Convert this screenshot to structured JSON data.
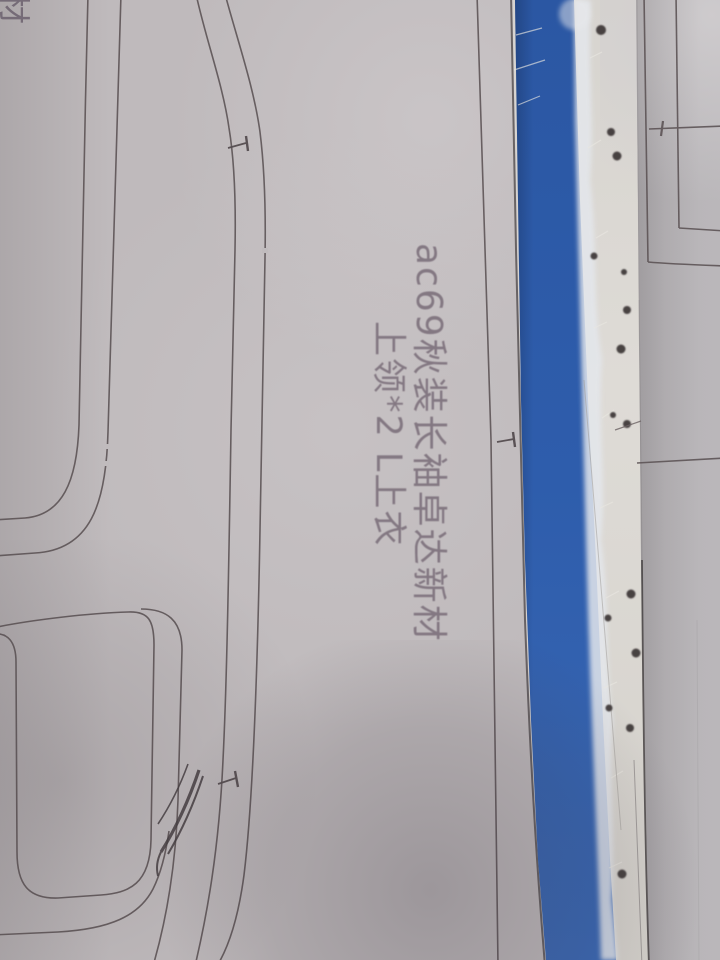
{
  "scene": {
    "type": "photograph",
    "subject": "Sewing pattern paper with handwritten marking, pencil pattern lines, and a blue fabric strip along a torn white paper edge",
    "colors": {
      "paper_left": "#bfbabc",
      "paper_right": "#b7b4b7",
      "white_paper_edge": "#d9d6d1",
      "blue_fabric": "#2d5cab",
      "pencil_line": "#5d5456",
      "ink_dot": "#383032",
      "handwriting": "#7e727d"
    }
  },
  "annotation": {
    "line1": "ac69秋装长袖卓达新材",
    "line2": "上领*2 L上衣",
    "corner_fragment": "材"
  }
}
